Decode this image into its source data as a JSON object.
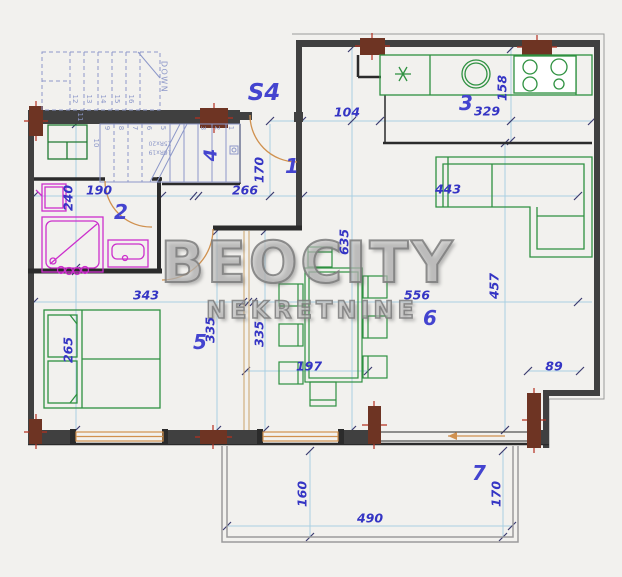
{
  "watermark": {
    "line1": "BEOCITY",
    "line2": "NEKRETNINE"
  },
  "rooms": {
    "s4": "S4",
    "r1": "1",
    "r2": "2",
    "r3": "3",
    "r4": "4",
    "r5": "5",
    "r6": "6",
    "r7": "7"
  },
  "dims": {
    "a104": "104",
    "a329": "329",
    "a158": "158",
    "a170_entry": "170",
    "a266": "266",
    "a190": "190",
    "a240": "240",
    "a635": "635",
    "a443": "443",
    "a457": "457",
    "a343": "343",
    "a556": "556",
    "a335_left": "335",
    "a335_right": "335",
    "a265": "265",
    "a197": "197",
    "a89": "89",
    "a160": "160",
    "a170_terrace": "170",
    "a490": "490"
  },
  "stairs": {
    "down": "DOWN",
    "spec_upper": "15Rx20",
    "spec_lower": "16Rx19",
    "upper_steps": [
      "12",
      "13",
      "14",
      "15",
      "16"
    ],
    "mid_step": "11",
    "lower_steps": [
      "10",
      "9",
      "8",
      "7",
      "6",
      "5",
      "3",
      "2",
      "1"
    ]
  },
  "colors": {
    "dimension_text": "#3535c4",
    "room_label": "#4444cf",
    "furniture": "#2e9140",
    "sanitary": "#cc2fcc",
    "door": "#d0914f",
    "column": "#6e3423",
    "column_tick": "#b5301f",
    "stair": "#8d98c9",
    "dim_line": "#a9cfe2",
    "wall": "#404040",
    "watermark": "#b8b8b8"
  }
}
